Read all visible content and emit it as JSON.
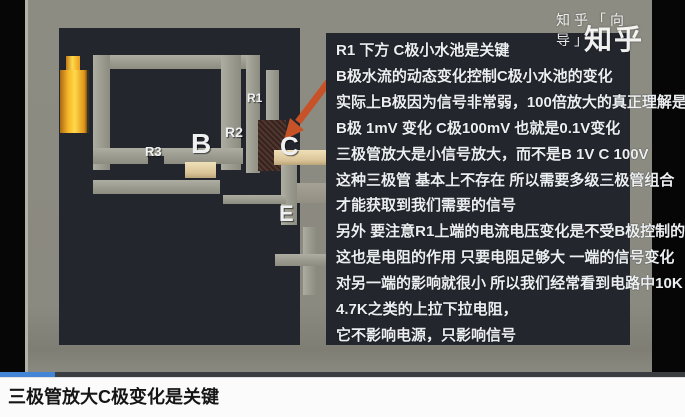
{
  "video": {
    "watermarks": {
      "small": "知乎「向导」",
      "large": "知乎"
    },
    "panel_text": {
      "lines": [
        "R1 下方 C极小水池是关键",
        "B极水流的动态变化控制C极小水池的变化",
        "实际上B极因为信号非常弱，100倍放大的真正理解是",
        "B极 1mV 变化 C极100mV 也就是0.1V变化",
        "三极管放大是小信号放大，而不是B 1V C 100V",
        "这种三极管 基本上不存在 所以需要多级三极管组合",
        "才能获取到我们需要的信号",
        "另外 要注意R1上端的电流电压变化是不受B极控制的",
        "这也是电阻的作用 只要电阻足够大 一端的信号变化",
        "对另一端的影响就很小 所以我们经常看到电路中10K",
        "4.7K之类的上拉下拉电阻，",
        "它不影响电源，只影响信号"
      ]
    },
    "scene": {
      "labels": {
        "r1": "R1",
        "r2": "R2",
        "r3": "R3",
        "b": "B",
        "c": "C",
        "e": "E"
      }
    }
  },
  "player": {
    "progress_percent": 8
  },
  "caption": {
    "title": "三极管放大C极变化是关键"
  },
  "colors": {
    "panel_dark": "#24262e",
    "video_gray": "#8b8a80",
    "pipe_gray": "#9a9a8f",
    "battery_yellow": "#ffd94a",
    "transistor_brown": "#46302a",
    "plank_tan": "#d9c396",
    "arrow_orange": "#c85227",
    "progress_blue": "#4285d6"
  }
}
